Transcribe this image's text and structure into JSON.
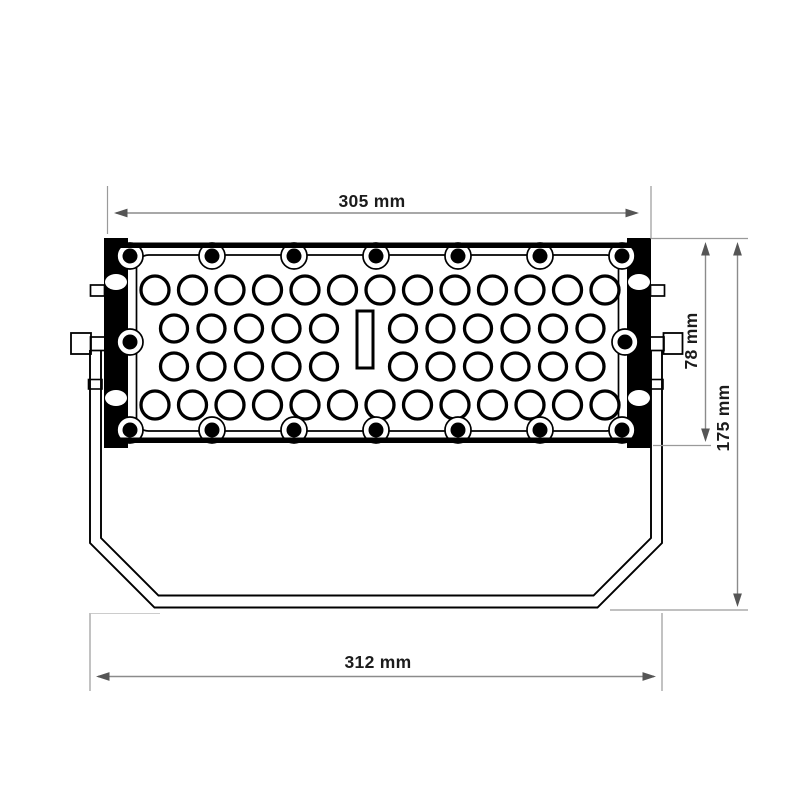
{
  "figure": {
    "type": "technical-dimension-drawing",
    "subject": "LED floodlight rear view with mounting yoke",
    "units": "mm",
    "dimensions": {
      "top_width": {
        "label": "305 mm",
        "value": 305,
        "unit": "mm"
      },
      "bracket_height": {
        "label": "78 mm",
        "value": 78,
        "unit": "mm"
      },
      "overall_height": {
        "label": "175 mm",
        "value": 175,
        "unit": "mm"
      },
      "bottom_width": {
        "label": "312 mm",
        "value": 312,
        "unit": "mm"
      }
    },
    "body": {
      "vent_holes": {
        "row_counts": [
          13,
          11,
          11,
          13
        ],
        "total": 48
      },
      "screws": {
        "top": 7,
        "bottom": 7,
        "sides": 2
      },
      "bracket_oval_holes_per_side": 2,
      "center_slot": 1
    },
    "colors": {
      "drawing_line": "#000000",
      "dimension_line": "#8b8b8b",
      "arrowhead": "#555555",
      "label_text": "#1c1c1c",
      "background": "#ffffff"
    }
  }
}
